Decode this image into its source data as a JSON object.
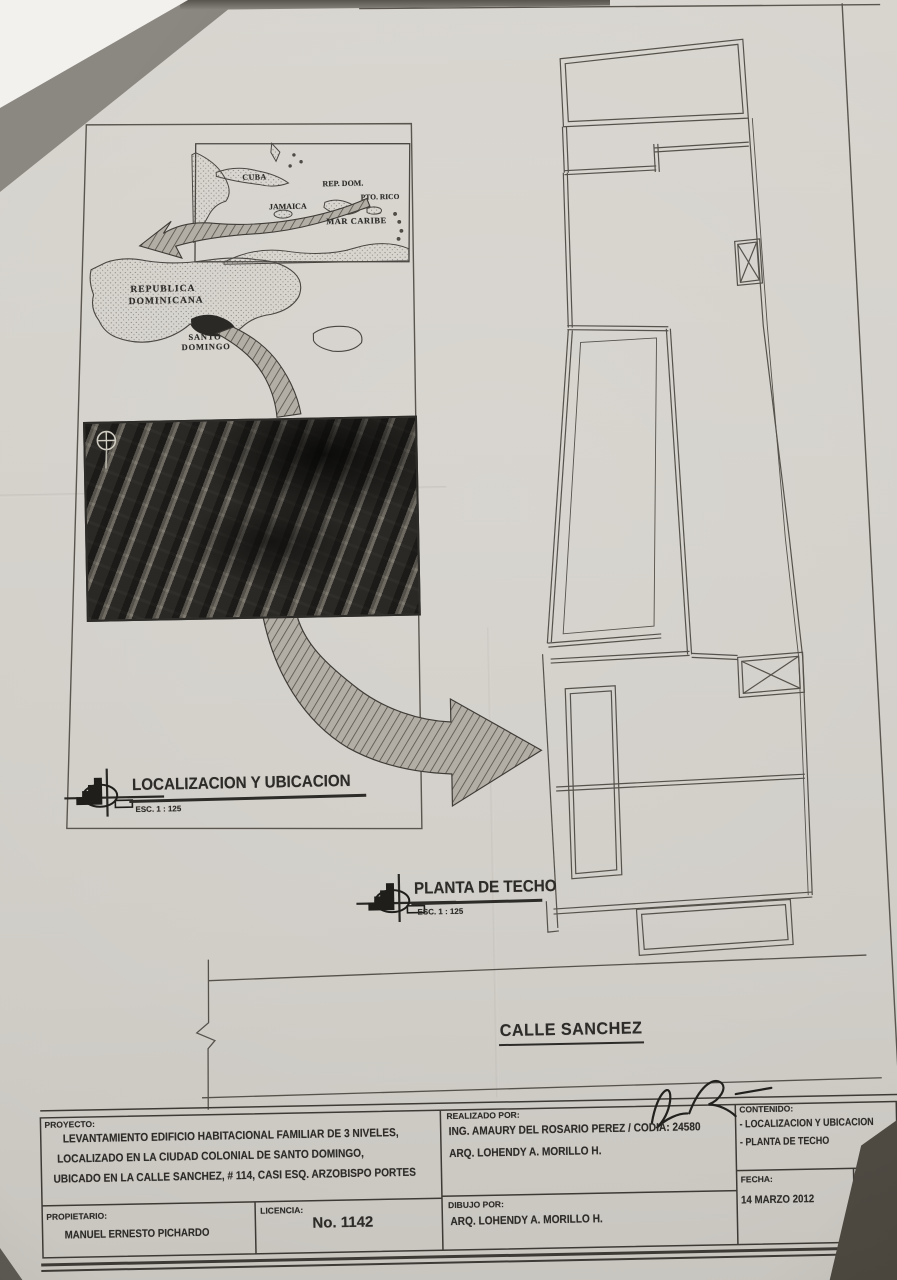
{
  "colors": {
    "paper": "#d4d1cb",
    "ink": "#2e2c29",
    "line": "#514e48"
  },
  "sheet": {
    "location_panel": {
      "title": "LOCALIZACION Y UBICACION",
      "scale": "ESC. 1 : 125",
      "caribbean_map": {
        "cuba": "CUBA",
        "rep_dom": "REP. DOM.",
        "pto_rico": "PTO. RICO",
        "jamaica": "JAMAICA",
        "mar_caribe": "MAR CARIBE"
      },
      "dr_map": {
        "country_line1": "REPUBLICA",
        "country_line2": "DOMINICANA",
        "city_line1": "SANTO",
        "city_line2": "DOMINGO"
      }
    },
    "roof_plan": {
      "title": "PLANTA DE TECHO",
      "scale": "ESC. 1 : 125"
    },
    "street_label": "CALLE SANCHEZ",
    "title_block": {
      "proyecto_label": "PROYECTO:",
      "proyecto_lines": [
        "LEVANTAMIENTO EDIFICIO HABITACIONAL FAMILIAR DE 3 NIVELES,",
        "LOCALIZADO EN LA CIUDAD COLONIAL DE SANTO DOMINGO,",
        "UBICADO EN LA CALLE SANCHEZ, # 114, CASI ESQ. ARZOBISPO PORTES"
      ],
      "propietario_label": "PROPIETARIO:",
      "propietario": "MANUEL ERNESTO PICHARDO",
      "licencia_label": "LICENCIA:",
      "licencia": "No. 1142",
      "realizado_label": "REALIZADO POR:",
      "realizado_line1": "ING. AMAURY DEL ROSARIO PEREZ / CODIA: 24580",
      "realizado_line2": "ARQ. LOHENDY A. MORILLO H.",
      "dibujo_label": "DIBUJO POR:",
      "dibujo": "ARQ. LOHENDY A. MORILLO H.",
      "contenido_label": "CONTENIDO:",
      "contenido_items": [
        "- LOCALIZACION Y UBICACION",
        "- PLANTA DE TECHO"
      ],
      "fecha_label": "FECHA:",
      "fecha": "14 MARZO 2012",
      "escala_label": "ESCALA:",
      "escala": "1 : 125",
      "signature": "97R"
    }
  }
}
